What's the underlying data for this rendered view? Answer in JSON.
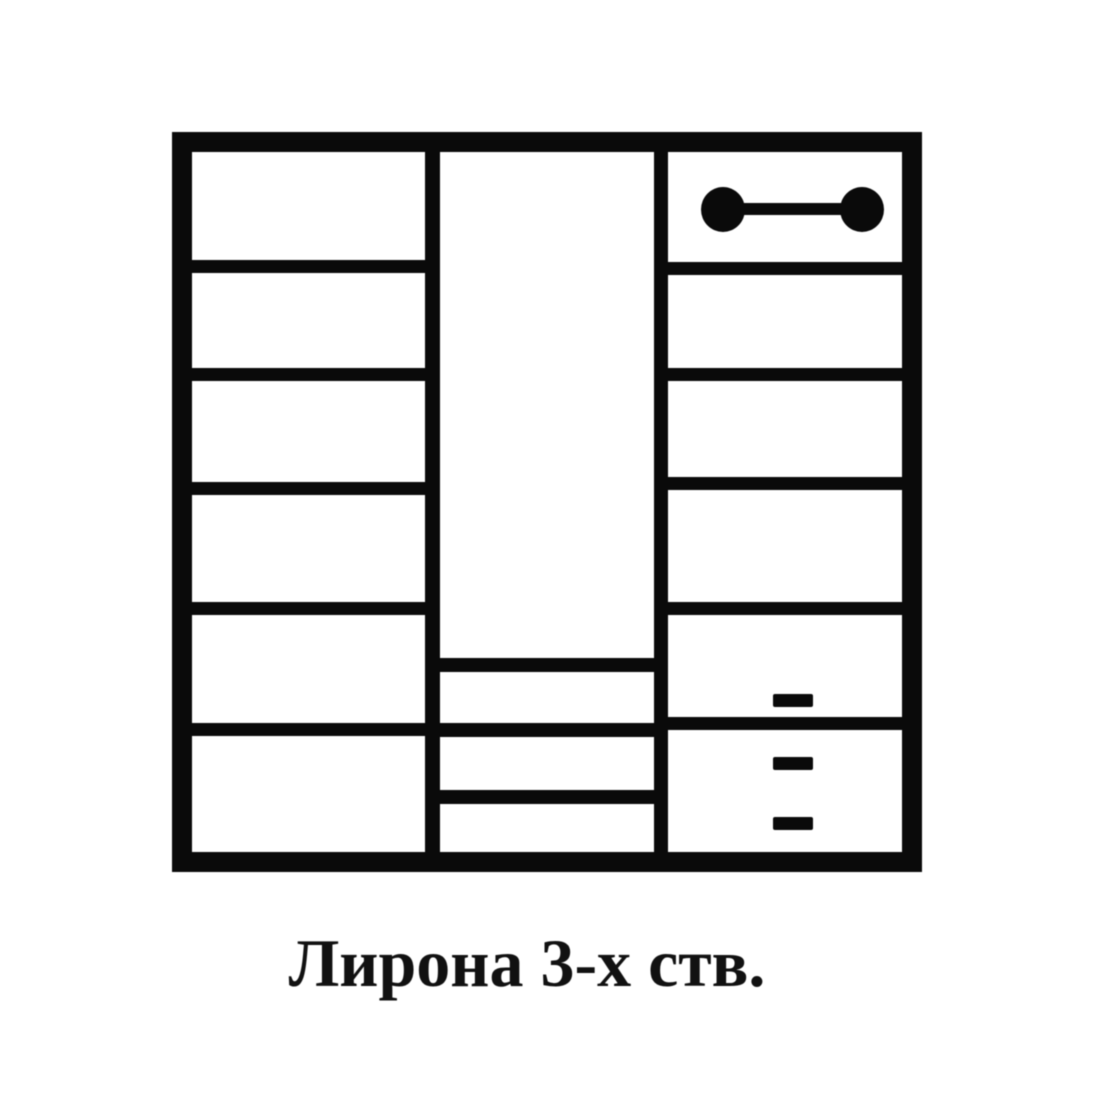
{
  "caption": {
    "text": "Лирона 3-х ств."
  },
  "diagram": {
    "kind": "wardrobe-front-schematic",
    "line_color": "#0a0a0a",
    "background_color": "#ffffff",
    "sections": {
      "left": {
        "compartments": 6,
        "shelf_tops": [
          108,
          216,
          330,
          450,
          571
        ],
        "shelf_thickness": 13
      },
      "middle": {
        "hanging_rod": {
          "end_centers_x": [
            283,
            422
          ],
          "end_top": 35,
          "end_width": 44,
          "end_height": 45,
          "bar_top": 51,
          "bar_thickness": 12
        },
        "drawers": {
          "count": 3,
          "line_tops": [
            506,
            571,
            638
          ],
          "line_thickness": 14,
          "handle_tops": [
            542,
            605,
            665
          ],
          "handle_width": 40,
          "handle_height": 13,
          "handle_center_x": 353
        }
      },
      "right": {
        "compartments": 6,
        "shelf_tops": [
          110,
          216,
          325,
          450,
          565
        ],
        "shelf_thickness": 13
      }
    }
  }
}
